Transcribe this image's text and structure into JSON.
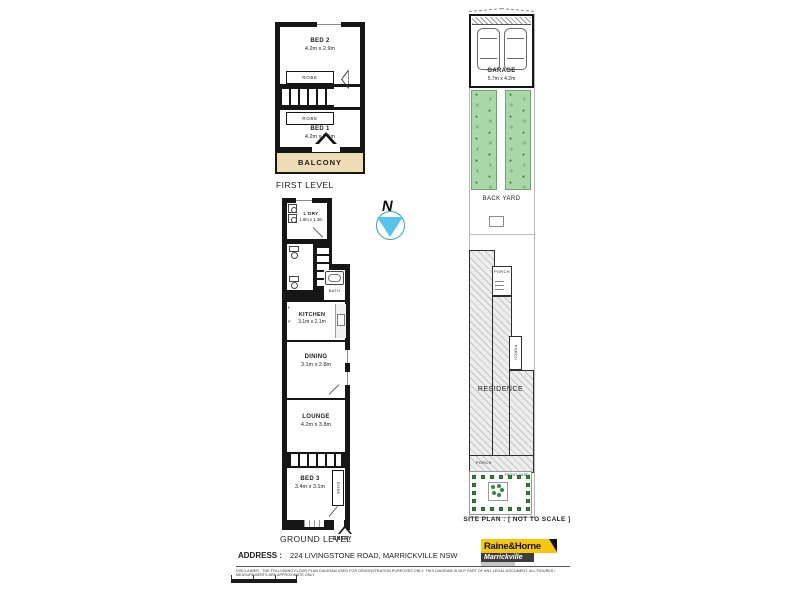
{
  "compass": {
    "n": "N"
  },
  "first_level": {
    "caption": "FIRST LEVEL",
    "bed2_name": "BED 2",
    "bed2_dims": "4.2m x 2.9m",
    "robe_top": "ROBE",
    "robe_bottom": "ROBE",
    "bed1_name": "BED 1",
    "bed1_dims": "4.2m x 3.1m",
    "balcony": "BALCONY"
  },
  "ground_level": {
    "caption": "GROUND LEVEL",
    "ldry_name": "L'DRY",
    "ldry_dims": "1.8m x 1.3m",
    "bath": "BATH",
    "kitchen_name": "KITCHEN",
    "kitchen_dims": "3.1m x 2.1m",
    "fridge": "F",
    "pantry": "P",
    "dining_name": "DINING",
    "dining_dims": "3.1m x 2.8m",
    "lounge_name": "LOUNGE",
    "lounge_dims": "4.2m x 3.8m",
    "bed3_name": "BED 3",
    "bed3_dims": "3.4m x 3.1m",
    "robe": "ROBE",
    "entry": "ENTRY"
  },
  "site_plan": {
    "caption": "SITE PLAN : [ NOT TO SCALE ]",
    "garage_name": "GARAGE",
    "garage_dims": "5.7m x 4.2m",
    "back_yard": "BACK YARD",
    "residence": "RESIDENCE",
    "porch_rear": "PORCH",
    "porch_side": "PORCH",
    "porch_front": "PORCH",
    "front_yard": "FRONT YARD"
  },
  "footer": {
    "address_label": "ADDRESS :",
    "address_value": "224 LIVINGSTONE ROAD, MARRICKVILLE  NSW",
    "disclaimer": "DISCLAIMER : THE FOLLOWING FLOOR PLAN DIAGRAM USED FOR DEMONSTRATION PURPOSES ONLY. THIS DIAGRAM IS NOT PART OF ANY LEGAL DOCUMENT. ALL FIGURES / MEASUREMENTS ARE APPROXIMATE ONLY",
    "brand": "Raine&Horne",
    "office": "Marrickville"
  },
  "icons": {
    "door": "◁",
    "plant_star": "✱",
    "plant_dot": "●"
  },
  "colors": {
    "wall": "#161616",
    "balcony": "#eddcb5",
    "yard-green": "#a9d7a9",
    "plant-green": "#2e8b3a",
    "compass-blue": "#57c4ee",
    "compass-ring": "#2fa8c4",
    "logo-yellow": "#f6c70e",
    "logo-dark": "#3d3d3f"
  }
}
